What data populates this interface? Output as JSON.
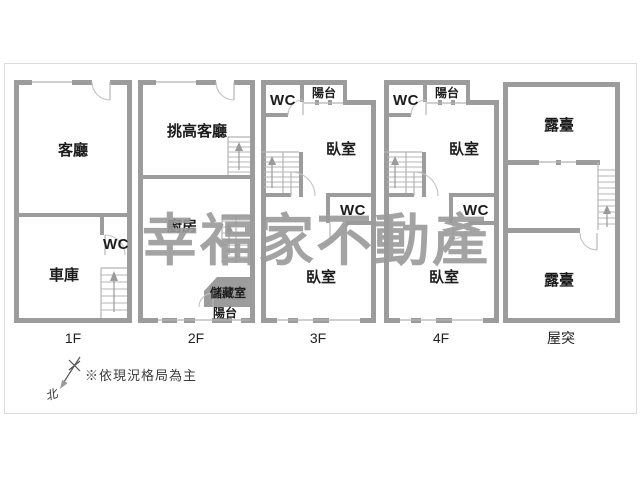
{
  "watermark": "幸福家不動產",
  "note": "※依現況格局為主",
  "compass": {
    "north_label": "北"
  },
  "floors": [
    {
      "name": "1F",
      "label": "1F",
      "rooms": {
        "living": "客廳",
        "wc": "WC",
        "garage": "車庫"
      }
    },
    {
      "name": "2F",
      "label": "2F",
      "rooms": {
        "tall_living": "挑高客廳",
        "kitchen": "廚房",
        "storage": "儲藏室",
        "balcony": "陽台"
      }
    },
    {
      "name": "3F",
      "label": "3F",
      "rooms": {
        "wc_top": "WC",
        "balcony": "陽台",
        "bedroom_top": "臥室",
        "wc_mid": "WC",
        "bedroom_bottom": "臥室"
      }
    },
    {
      "name": "4F",
      "label": "4F",
      "rooms": {
        "wc_top": "WC",
        "balcony": "陽台",
        "bedroom_top": "臥室",
        "wc_mid": "WC",
        "bedroom_bottom": "臥室"
      }
    },
    {
      "name": "roof",
      "label": "屋突",
      "rooms": {
        "terrace_top": "露臺",
        "terrace_bottom": "露臺"
      }
    }
  ],
  "colors": {
    "wall": "#9c9c9c",
    "thin_line": "#b4b4b4",
    "text": "#1c1c1c",
    "watermark": "#9a9a9a",
    "frame": "#dcdcdc",
    "background": "#ffffff"
  }
}
